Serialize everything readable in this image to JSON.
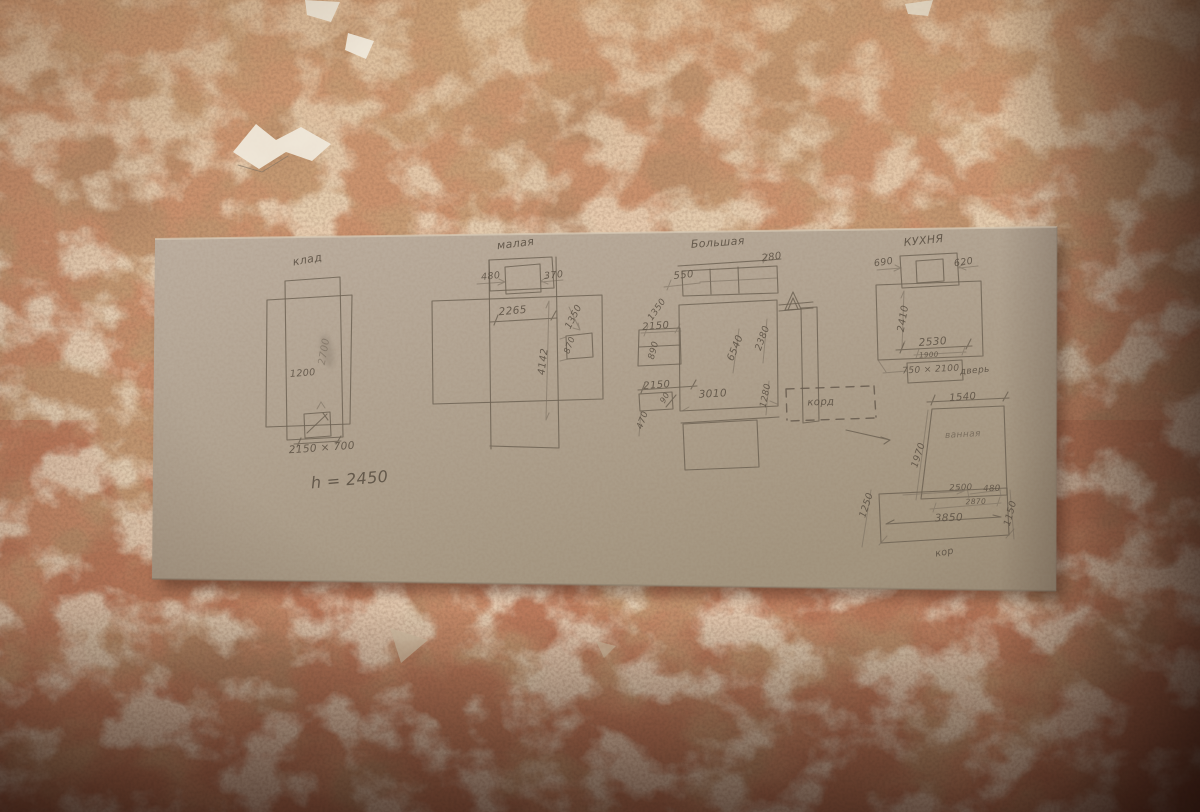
{
  "scene": {
    "description": "Pencil floor-plan sketches of apartment rooms drawn on a cardboard sheet lying on a worn red-brown plaster wall",
    "palette": {
      "wall_base": "#c59a74",
      "wall_red_patch": "#9e4a2c",
      "wall_light_patch": "#e0c6a2",
      "wall_shadow": "#2a100a",
      "cardboard": "#b2a492",
      "pencil": "#6b6052",
      "paint_chip_white": "#efe8da"
    }
  },
  "sketches": [
    {
      "id": "klad",
      "title": "клад",
      "labels": [
        {
          "t": "клад",
          "x": 308,
          "y": 263,
          "r": -10,
          "s": 11,
          "cls": "title"
        },
        {
          "t": "2700",
          "x": 327,
          "y": 352,
          "r": -80,
          "s": 10,
          "cls": "smudged"
        },
        {
          "t": "1200",
          "x": 303,
          "y": 376,
          "r": -4,
          "s": 9.5
        },
        {
          "t": "2150 × 700",
          "x": 322,
          "y": 451,
          "r": -4,
          "s": 10.5
        },
        {
          "t": "h = 2450",
          "x": 350,
          "y": 485,
          "r": -5,
          "s": 16,
          "cls": "title"
        }
      ]
    },
    {
      "id": "malaya",
      "title": "малая",
      "labels": [
        {
          "t": "малая",
          "x": 516,
          "y": 247,
          "r": -7,
          "s": 11,
          "cls": "title"
        },
        {
          "t": "480",
          "x": 491,
          "y": 279,
          "r": -6,
          "s": 9.5
        },
        {
          "t": "370",
          "x": 554,
          "y": 278,
          "r": -6,
          "s": 9.5
        },
        {
          "t": "2265",
          "x": 513,
          "y": 314,
          "r": -5,
          "s": 10.5
        },
        {
          "t": "1350",
          "x": 576,
          "y": 318,
          "r": -63,
          "s": 9.5
        },
        {
          "t": "870",
          "x": 572,
          "y": 346,
          "r": -70,
          "s": 8.5
        },
        {
          "t": "4142",
          "x": 546,
          "y": 362,
          "r": -83,
          "s": 10
        }
      ]
    },
    {
      "id": "bolshaya",
      "title": "Большая",
      "labels": [
        {
          "t": "Большая",
          "x": 718,
          "y": 246,
          "r": -4,
          "s": 11,
          "cls": "title"
        },
        {
          "t": "280",
          "x": 772,
          "y": 260,
          "r": -8,
          "s": 10
        },
        {
          "t": "550",
          "x": 684,
          "y": 278,
          "r": -6,
          "s": 10
        },
        {
          "t": "1350",
          "x": 659,
          "y": 311,
          "r": -55,
          "s": 9
        },
        {
          "t": "2150",
          "x": 656,
          "y": 329,
          "r": -4,
          "s": 10
        },
        {
          "t": "890",
          "x": 656,
          "y": 351,
          "r": -75,
          "s": 9
        },
        {
          "t": "2150",
          "x": 657,
          "y": 388,
          "r": -4,
          "s": 10
        },
        {
          "t": "90",
          "x": 667,
          "y": 399,
          "r": -60,
          "s": 8
        },
        {
          "t": "470",
          "x": 645,
          "y": 421,
          "r": -70,
          "s": 9
        },
        {
          "t": "3010",
          "x": 713,
          "y": 397,
          "r": -3,
          "s": 10.5
        },
        {
          "t": "6540",
          "x": 738,
          "y": 349,
          "r": -68,
          "s": 10
        },
        {
          "t": "2380",
          "x": 765,
          "y": 339,
          "r": -70,
          "s": 9.5
        },
        {
          "t": "1280",
          "x": 768,
          "y": 396,
          "r": -78,
          "s": 9
        },
        {
          "t": "корд",
          "x": 821,
          "y": 405,
          "r": -2,
          "s": 10,
          "cls": "title"
        }
      ]
    },
    {
      "id": "kuhnya",
      "title": "КУХНЯ",
      "labels": [
        {
          "t": "КУХНЯ",
          "x": 924,
          "y": 244,
          "r": -6,
          "s": 11,
          "cls": "title"
        },
        {
          "t": "690",
          "x": 884,
          "y": 265,
          "r": -8,
          "s": 9.5
        },
        {
          "t": "620",
          "x": 964,
          "y": 265,
          "r": -8,
          "s": 9.5
        },
        {
          "t": "2410",
          "x": 906,
          "y": 319,
          "r": -80,
          "s": 10
        },
        {
          "t": "2530",
          "x": 933,
          "y": 345,
          "r": -4,
          "s": 10.5
        },
        {
          "t": "1900",
          "x": 929,
          "y": 357,
          "r": -3,
          "s": 7
        },
        {
          "t": "750 × 2100",
          "x": 931,
          "y": 372,
          "r": -3,
          "s": 9
        },
        {
          "t": "дверь",
          "x": 975,
          "y": 373,
          "r": -5,
          "s": 9,
          "cls": "title"
        }
      ]
    },
    {
      "id": "vannaya-koridor",
      "title": "ванная",
      "labels": [
        {
          "t": "1540",
          "x": 963,
          "y": 400,
          "r": -4,
          "s": 10
        },
        {
          "t": "ванная",
          "x": 963,
          "y": 437,
          "r": -3,
          "s": 9,
          "cls": "faint"
        },
        {
          "t": "1970",
          "x": 921,
          "y": 456,
          "r": -72,
          "s": 9.5
        },
        {
          "t": "2500",
          "x": 961,
          "y": 490,
          "r": -2,
          "s": 8.5
        },
        {
          "t": "480",
          "x": 992,
          "y": 491,
          "r": -2,
          "s": 8.5
        },
        {
          "t": "2870",
          "x": 976,
          "y": 504,
          "r": -2,
          "s": 7.5
        },
        {
          "t": "3850",
          "x": 949,
          "y": 521,
          "r": -2,
          "s": 10.5
        },
        {
          "t": "1250",
          "x": 869,
          "y": 506,
          "r": -72,
          "s": 9.5
        },
        {
          "t": "1150",
          "x": 1013,
          "y": 514,
          "r": -75,
          "s": 9.5
        },
        {
          "t": "кор",
          "x": 945,
          "y": 555,
          "r": -10,
          "s": 9.5,
          "cls": "title"
        }
      ]
    }
  ]
}
